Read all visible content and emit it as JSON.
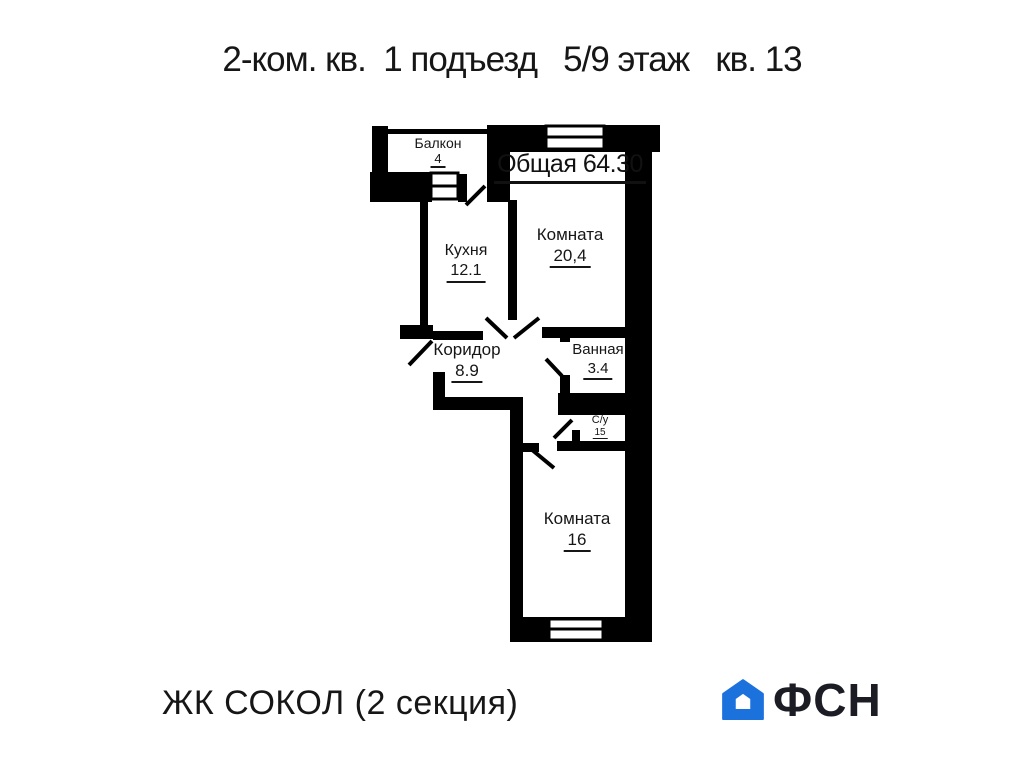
{
  "title": "2-ком. кв.  1 подъезд   5/9 этаж   кв. 13",
  "plan": {
    "total_label": "Общая 64.30",
    "wall_color": "#000000",
    "rooms": [
      {
        "name": "Балкон",
        "area": "4"
      },
      {
        "name": "Кухня",
        "area": "12.1"
      },
      {
        "name": "Комната",
        "area": "20,4"
      },
      {
        "name": "Коридор",
        "area": "8.9"
      },
      {
        "name": "Ванная",
        "area": "3.4"
      },
      {
        "name": "С/у",
        "area": "15"
      },
      {
        "name": "Комната",
        "area": "16"
      }
    ]
  },
  "footer": {
    "project": "ЖК СОКОЛ (2 секция)",
    "logo_text": "ФСН",
    "logo_blue": "#1c72dd",
    "logo_dark": "#1c1c24"
  }
}
